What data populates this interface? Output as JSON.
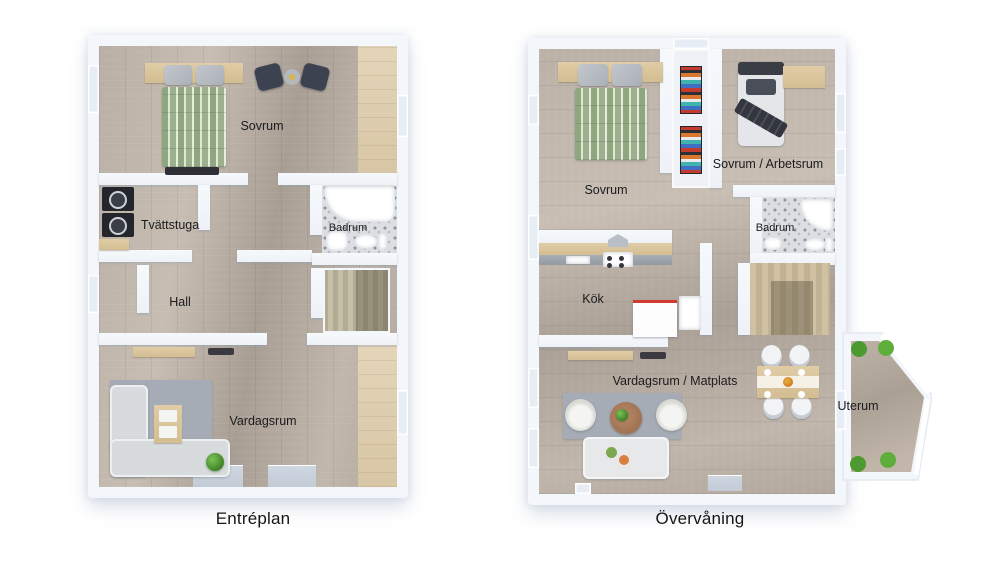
{
  "figure": {
    "type": "floor-plan-pair",
    "background": "#ffffff"
  },
  "plans": [
    {
      "id": "entreplan",
      "caption": "Entréplan",
      "rooms": [
        {
          "id": "sovrum",
          "label": "Sovrum"
        },
        {
          "id": "tvattstuga",
          "label": "Tvättstuga"
        },
        {
          "id": "badrum",
          "label": "Badrum"
        },
        {
          "id": "hall",
          "label": "Hall"
        },
        {
          "id": "vardagsrum",
          "label": "Vardagsrum"
        }
      ]
    },
    {
      "id": "overvaning",
      "caption": "Övervåning",
      "rooms": [
        {
          "id": "sovrum",
          "label": "Sovrum"
        },
        {
          "id": "sovrum-arbetsrum",
          "label": "Sovrum / Arbetsrum"
        },
        {
          "id": "badrum",
          "label": "Badrum"
        },
        {
          "id": "kok",
          "label": "Kök"
        },
        {
          "id": "vardagsrum-matplats",
          "label": "Vardagsrum / Matplats"
        },
        {
          "id": "uterum",
          "label": "Uterum"
        }
      ]
    }
  ],
  "colors": {
    "wall": "#f3f6fa",
    "floor_wood_gray": "#b8aea4",
    "floor_wood_light": "#ddcba8",
    "bathroom_tile": "#dcdee2",
    "duvet_green": "#96ab85",
    "sofa_gray": "#d8dbde",
    "rug_gray": "#a6acb6",
    "plant_green": "#4c9a30",
    "island_red": "#d23b2f",
    "appliance_black": "#24262b",
    "label_text": "#1b1b1d"
  }
}
